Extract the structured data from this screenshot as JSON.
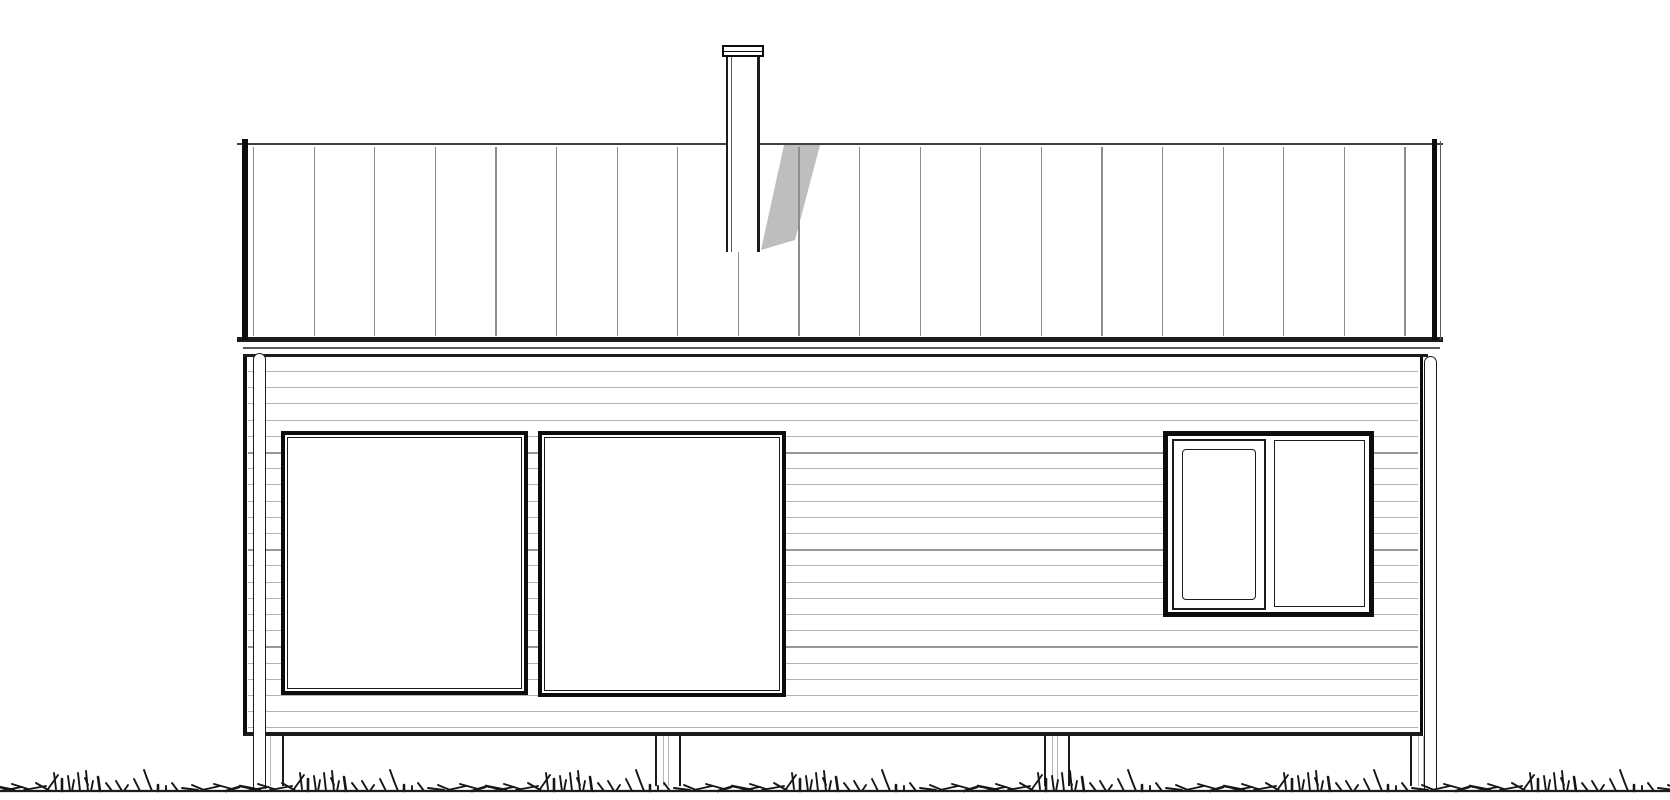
{
  "canvas": {
    "width": 1670,
    "height": 800,
    "background": "#ffffff"
  },
  "palette": {
    "line_black": "#0d0d0d",
    "line_dark": "#1c1c1c",
    "line_medium": "#3f3f3f",
    "line_soft": "#5a5a5a",
    "seam_gray": "#8d8d8d",
    "siding_gray": "#b4b4b4",
    "siding_gray_dark": "#979797",
    "shadow_gray": "#b7b7b7",
    "grass_ink": "#161616",
    "white": "#ffffff"
  },
  "roof": {
    "x": 237,
    "y": 143,
    "width": 1206,
    "height": 196,
    "ridge_y": 142.5,
    "ridge_thickness": 2.5,
    "eave_y": 337,
    "eave_thickness": 5,
    "rake_left": {
      "x": 242,
      "y": 139,
      "width": 6,
      "height": 201
    },
    "rake_right": {
      "x": 1432,
      "y": 139,
      "width": 5,
      "height": 201
    },
    "rake_right_thin": {
      "x": 1440,
      "y": 141,
      "width": 1.3,
      "height": 199
    },
    "seams": {
      "first_x": 253,
      "spacing": 60.6,
      "count": 20,
      "top": 147,
      "bottom": 336,
      "width": 1.3
    }
  },
  "fascia": {
    "sub_line": {
      "x": 243,
      "y": 347,
      "width": 1197,
      "height": 1.5
    },
    "wall_top_line": {
      "x": 243,
      "y": 354,
      "width": 1185,
      "height": 3
    }
  },
  "wall": {
    "x": 243,
    "y": 357,
    "width": 1180,
    "height": 379,
    "border_left": 4,
    "border_right": 3,
    "border_bottom": 4,
    "siding": {
      "first_y": 371,
      "spacing": 16.2,
      "count": 23,
      "x": 248,
      "width": 1170
    }
  },
  "chimney": {
    "cap": {
      "x": 722,
      "y": 45,
      "width": 42,
      "height": 12
    },
    "cap_band_y": 51,
    "flue": {
      "x": 726,
      "y": 56,
      "width": 34,
      "height": 196
    },
    "flue_inner_line_offset": 5,
    "shadow_points": [
      [
        784,
        145
      ],
      [
        820,
        145
      ],
      [
        795,
        240
      ],
      [
        761,
        250
      ]
    ]
  },
  "windows": [
    {
      "id": "picture-window-left",
      "type": "fixed-double-frame",
      "x": 281,
      "y": 431,
      "width": 247,
      "height": 264
    },
    {
      "id": "picture-window-center",
      "type": "fixed-double-frame",
      "x": 538,
      "y": 431,
      "width": 248,
      "height": 266
    },
    {
      "id": "casement-window-right",
      "type": "two-pane",
      "x": 1163,
      "y": 431,
      "width": 211,
      "height": 186,
      "casement": {
        "x": 4,
        "y": 3,
        "width": 94,
        "height": 171,
        "sash_inset": 8
      },
      "fixed_pane": {
        "x": 106,
        "y": 4,
        "width": 91,
        "height": 167
      }
    }
  ],
  "downspouts": [
    {
      "x": 253,
      "y": 353,
      "width": 13,
      "height": 436
    },
    {
      "x": 1424,
      "y": 356,
      "width": 13,
      "height": 433
    }
  ],
  "foundation": {
    "post_top": 736,
    "post_height": 50,
    "posts": [
      {
        "x": 257,
        "width": 27
      },
      {
        "x": 655,
        "width": 26
      },
      {
        "x": 1044,
        "width": 26
      },
      {
        "x": 1410,
        "width": 27
      }
    ]
  },
  "grass": {
    "baseline_y": 791,
    "baseline_thickness": 2.2,
    "repeat_width": 246,
    "repeat_start": -8,
    "repeat_count": 8,
    "stroke_width": 1.9,
    "strokes": [
      [
        2,
        5,
        22,
        1
      ],
      [
        8,
        0,
        30,
        4
      ],
      [
        20,
        7,
        36,
        2
      ],
      [
        32,
        1,
        54,
        5
      ],
      [
        44,
        8,
        58,
        0
      ],
      [
        56,
        2,
        66,
        16
      ],
      [
        62,
        18,
        64,
        2
      ],
      [
        70,
        12,
        70,
        0
      ],
      [
        76,
        15,
        78,
        0
      ],
      [
        82,
        11,
        80,
        0
      ],
      [
        86,
        18,
        88,
        0
      ],
      [
        93,
        13,
        96,
        6
      ],
      [
        94,
        20,
        96,
        0
      ],
      [
        101,
        10,
        99,
        0
      ],
      [
        106,
        14,
        108,
        0
      ],
      [
        114,
        8,
        120,
        0
      ],
      [
        124,
        10,
        130,
        0
      ],
      [
        136,
        6,
        132,
        0
      ],
      [
        142,
        12,
        148,
        0
      ],
      [
        152,
        21,
        156,
        10
      ],
      [
        156,
        10,
        160,
        0
      ],
      [
        166,
        6,
        166,
        0
      ],
      [
        174,
        5,
        174,
        0
      ],
      [
        180,
        8,
        186,
        0
      ],
      [
        190,
        3,
        206,
        1
      ],
      [
        200,
        6,
        212,
        1
      ],
      [
        210,
        1,
        228,
        5
      ],
      [
        222,
        7,
        240,
        2
      ],
      [
        234,
        0,
        247,
        4
      ]
    ]
  }
}
